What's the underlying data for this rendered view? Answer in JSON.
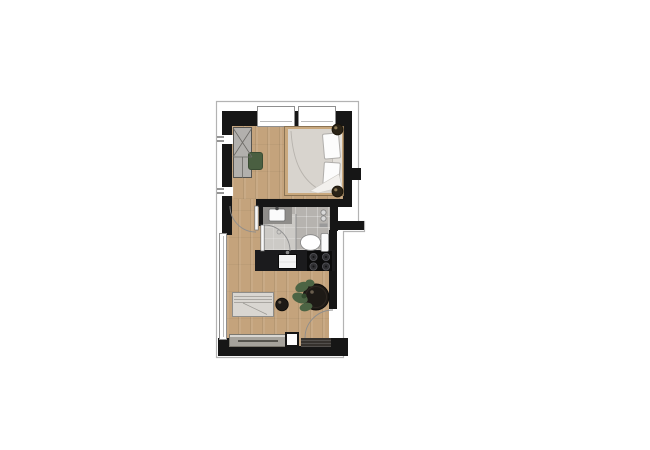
{
  "view": {
    "type": "floor-plan",
    "unit": "studio-apartment",
    "orientation": "top-down"
  },
  "colors": {
    "wall": "#161616",
    "outline": "#b3b3b3",
    "wood_floor": "#c4a37c",
    "bath_tile": "#b6b3af",
    "counter_black": "#1b1b1d",
    "cooktop_black": "#0c0c0c",
    "fabric_gray": "#d9d6d1",
    "bedding_gray": "#d8d4ce",
    "mattress": "#e4e1dc",
    "pillow_white": "#fcfcfc",
    "bed_frame_wood": "#c9a87d",
    "wardrobe_gray": "#b2b0ad",
    "sideboard_gray": "#a5a29b",
    "cabinet_white": "#fdfdfd",
    "doormat_dark": "#36322e",
    "plant_green": "#4c6444",
    "pouf_green": "#4a5f41",
    "table_black": "#1e1a16",
    "fixture_white": "#fbfbfb"
  },
  "rooms": [
    {
      "name": "bedroom",
      "furniture": [
        "wardrobe",
        "pouf",
        "double-bed",
        "pillow",
        "pillow",
        "nightstand",
        "nightstand"
      ]
    },
    {
      "name": "bathroom",
      "furniture": [
        "washbasin",
        "shower",
        "toilet",
        "towel-hooks"
      ]
    },
    {
      "name": "kitchen",
      "furniture": [
        "countertop",
        "kitchen-sink",
        "cooktop"
      ]
    },
    {
      "name": "living-area",
      "furniture": [
        "sofa",
        "side-table",
        "dining-table",
        "plant",
        "sideboard",
        "cabinet",
        "doormat"
      ]
    }
  ],
  "openings": {
    "top_windows": 2,
    "side_window": 1,
    "interior_doors": [
      "bedroom-door",
      "bathroom-door"
    ],
    "entrance_doors": [
      "entrance-door"
    ]
  }
}
